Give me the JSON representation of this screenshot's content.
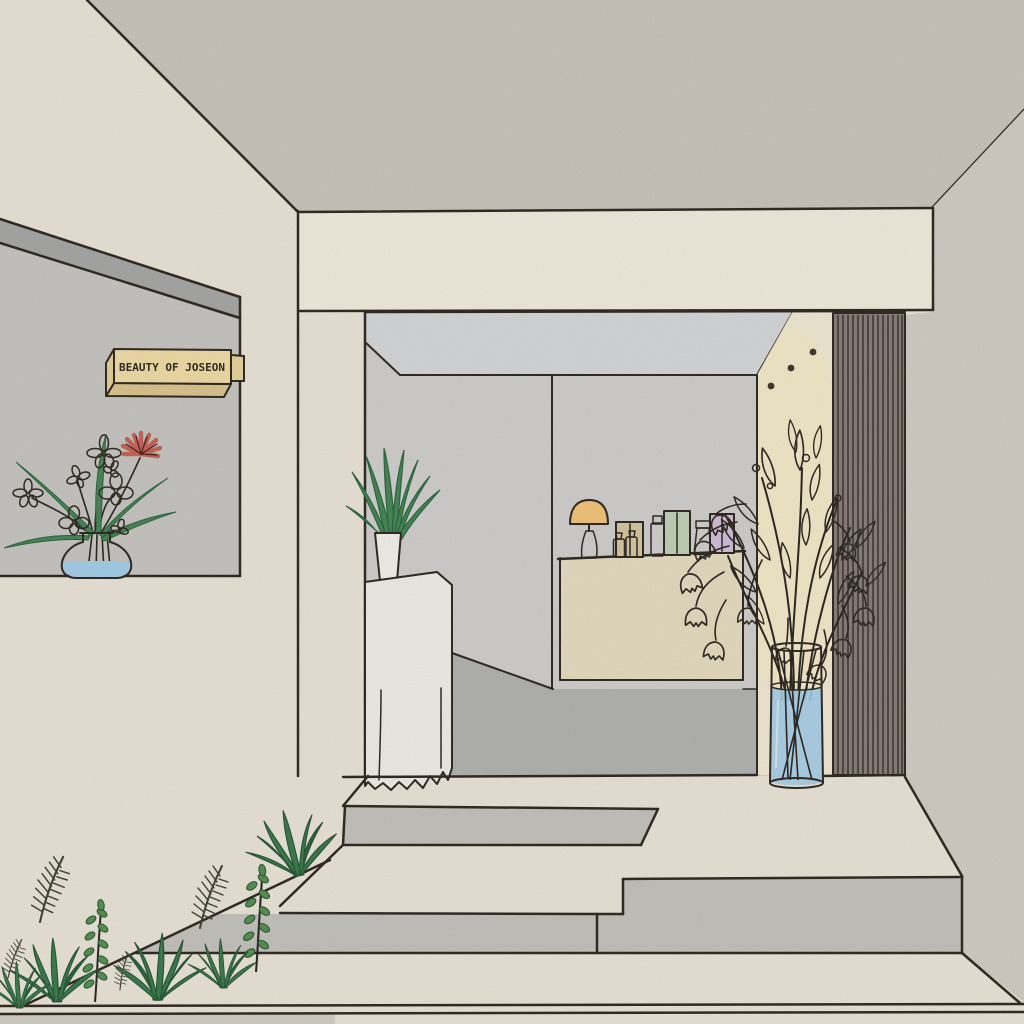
{
  "scene": {
    "description": "Hand-drawn illustration of a minimalist skincare shop storefront with entrance steps, plants and a product counter",
    "objects": [
      "ceiling",
      "fascia-beam",
      "left-display-wall",
      "hanging-sign",
      "window-flower-vase",
      "shop-interior",
      "back-wall",
      "lit-panel",
      "wood-slat-wall",
      "counter",
      "table-lamp",
      "skincare-products",
      "pedestal-plant",
      "tall-vase-bell-flowers",
      "entrance-steps",
      "garden-plants"
    ]
  },
  "sign": {
    "text": "BEAUTY OF JOSEON"
  },
  "palette": {
    "paper": "#EFE8DB",
    "ceiling": "#CFC8C0",
    "outer_right_wall": "#D6D0C8",
    "beam": "#F6F0E2",
    "left_wall_top": "#ABABA9",
    "left_wall_face": "#CBC9C5",
    "interior_wall": "#D4D3D1",
    "interior_ceiling": "#DADBDC",
    "interior_floor": "#B6B7B5",
    "lit_panel": "#F4ECD6",
    "panel_glow": "#F9EFC6",
    "slat_wall": "#8D817C",
    "slat_line": "#3A332C",
    "counter": "#E9E0C4",
    "pedestal": "#F4F2EB",
    "pot_white": "#F7F5EF",
    "step_riser": "#C8C6C0",
    "under_bed": "#D6D2C9",
    "sign_front": "#F4E0A9",
    "sign_side": "#E9D49C",
    "sign_bottom": "#DFC891",
    "sign_tab": "#EBD79F",
    "sign_text_color": "#33302A",
    "lamp_shade": "#F6C87D",
    "lamp_base": "#211D1A",
    "water": "#A8D2EC",
    "leaf_green": "#4B8A58",
    "leaf_dark": "#2E6B44",
    "grass_green": "#3E7F50",
    "leafy_green": "#5B9454",
    "fern_ink": "#44473A",
    "stem_dark": "#2F2A24",
    "flower_lavender": "#A9A9DF",
    "flower_pink": "#EBB7DC",
    "flower_tan": "#CDA365",
    "flower_coral": "#C9685A",
    "flower_peach": "#F8C68F",
    "product_tan_box": "#D8CBA3",
    "product_green_bottle": "#CCDAC6",
    "product_green_box": "#C3D5BA",
    "product_purple_tube": "#DCCAE3",
    "product_purple_box": "#D4C2DD",
    "bottle_glass": "#EDE7D6",
    "cap_brown": "#8C7B5E",
    "dot_brown": "#463B2F",
    "outline": "#332D26"
  }
}
